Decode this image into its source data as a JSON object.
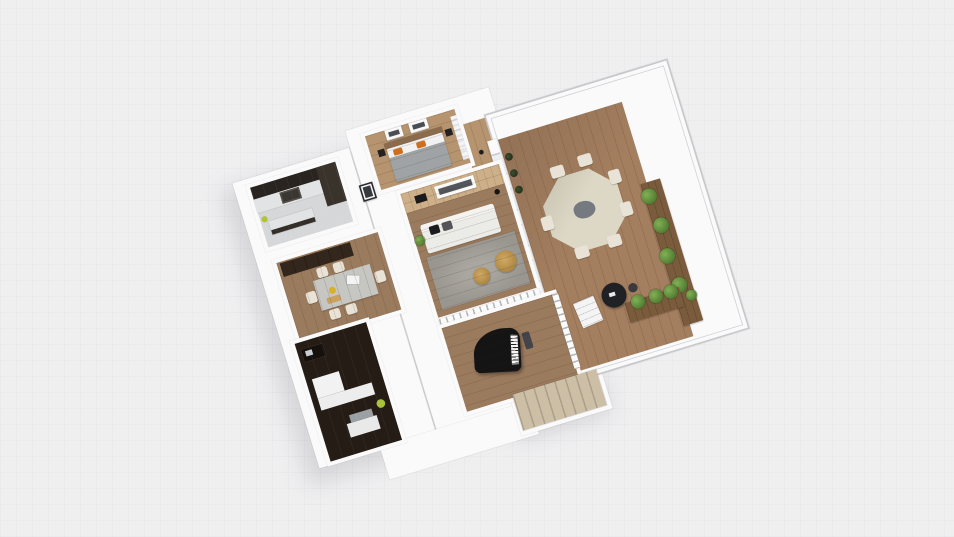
{
  "scene": {
    "description": "3D isometric floor plan render of an apartment with terrace",
    "background": {
      "color": "#f0eff0",
      "grid_color": "#e8e7e9"
    },
    "palette": {
      "wall": "#fafafa",
      "wall_edge": "#c6c7ca",
      "wood_light": "#b5946f",
      "wood_mid": "#9b7b5e",
      "oak_accent_wall": "#cdb08a",
      "deck": "#a37e5f",
      "kitchen_floor": "#d6d7d9",
      "dark_cabinet": "#2a2420",
      "counter": "#e2e3e5",
      "appliance": "#3a3631",
      "wardrobe": "#33271d",
      "office_floor": "#241c15",
      "sofa": "#ebebe8",
      "rug": "#999690",
      "bed_blanket": "#a0a3a5",
      "pillow_orange": "#cf6f1e",
      "pillow_black": "#1c1c1e",
      "pillow_gray": "#55555a",
      "dining_table": "#c6c6c3",
      "chair_cream": "#e8e3d6",
      "terrace_table": "#ddd8c5",
      "centerpiece": "#757a80",
      "planter_wood": "#7a5c3c",
      "plant_green": "#527d33",
      "plant_yellowgreen": "#a8c23a",
      "stairs_beige": "#ccbfa6",
      "piano_black": "#141414",
      "black_table": "#202124",
      "pouf_tan": "#bd9554",
      "headboard": "#8a6b4e"
    },
    "rooms": [
      {
        "name": "kitchen",
        "floor": "#d6d7d9",
        "items": [
          "tall-dark-cabinets",
          "white-counter",
          "stove",
          "island",
          "small-plant"
        ]
      },
      {
        "name": "bedroom",
        "floor": "#b5946f",
        "items": [
          "double-bed",
          "orange-pillows",
          "two-wall-art-frames",
          "nightstands",
          "curtains"
        ]
      },
      {
        "name": "living-room",
        "floor": "#9b7b5e",
        "items": [
          "oak-accent-wall",
          "wall-art",
          "tv",
          "white-sofa",
          "gray-rug",
          "wicker-poufs",
          "floor-lamp",
          "plant"
        ]
      },
      {
        "name": "dining-room",
        "floor": "#9b7b5e",
        "items": [
          "dark-wardrobe",
          "gray-dining-table",
          "cream-chairs",
          "tableware"
        ]
      },
      {
        "name": "office",
        "floor": "#241c15",
        "items": [
          "dark-desk",
          "laptop",
          "white-furniture",
          "gray-bench",
          "plant"
        ]
      },
      {
        "name": "piano-room",
        "floor": "#9b7b5e",
        "items": [
          "grand-piano",
          "piano-bench",
          "stair-railing"
        ]
      },
      {
        "name": "terrace",
        "floor": "#a37e5f",
        "items": [
          "octagon-dining-table",
          "centerpiece",
          "cream-chairs",
          "planter-boxes",
          "plants",
          "black-round-table",
          "white-deck-steps",
          "glass-pergola-frame",
          "potted-plant"
        ]
      },
      {
        "name": "staircase",
        "floor": "#ccbfa6",
        "items": [
          "beige-steps"
        ]
      }
    ],
    "camera": {
      "view": "3d-orbit",
      "rotation_deg": -17
    }
  }
}
